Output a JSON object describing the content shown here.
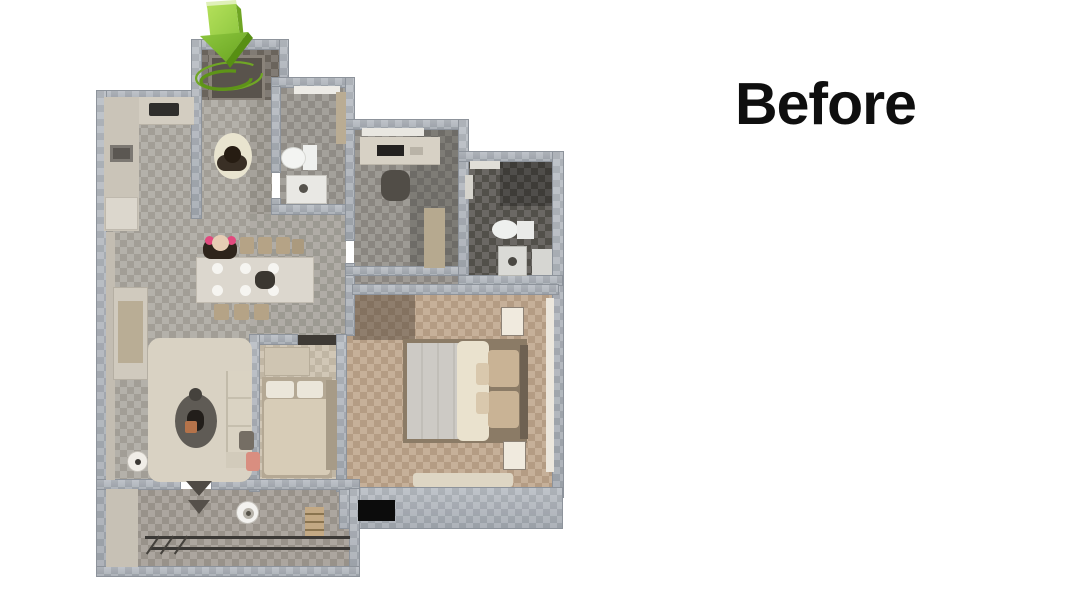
{
  "annotation": {
    "label": "Before"
  },
  "palette": {
    "background": "#ffffff",
    "text": "#0f0f0f",
    "wall_light": "#b4b9c0",
    "wall_dark": "#9fa5ad",
    "wall_edge": "#8d939b",
    "accent_green": "#8dc63f",
    "accent_green_light": "#a9da4d",
    "accent_green_dark": "#5f9716",
    "ring_green": "#70a625"
  },
  "icons": {
    "entrance_arrow": "green-3d-down-arrow",
    "entrance_ring": "green-rotation-ellipse"
  }
}
